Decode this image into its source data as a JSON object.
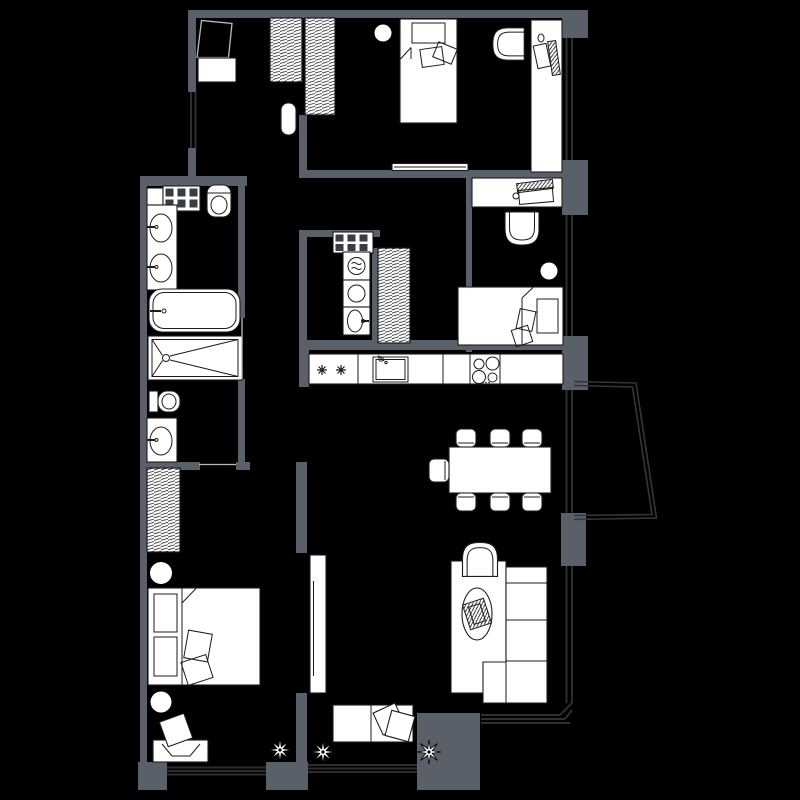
{
  "meta": {
    "kind": "apartment-floor-plan",
    "canvas": {
      "width": 800,
      "height": 800
    },
    "visible_text": "none"
  },
  "palette": {
    "background": "#000000",
    "wall": "#5a606a",
    "furniture_fill": "#ffffff",
    "furniture_stroke": "#1c1c1c",
    "window_line": "#2c2e33",
    "balcony_line": "#33363b",
    "door_line": "#b9bdc3",
    "grid_square": "#383d44"
  },
  "rooms": [
    {
      "name": "entry-hall",
      "furniture": [
        "entrance-door-swing",
        "cabinet",
        "wardrobe-hatched",
        "pouf"
      ]
    },
    {
      "name": "bedroom-top-right",
      "furniture": [
        "wardrobe-hatched",
        "single-bed",
        "pillows",
        "ceiling-lamp",
        "tub-armchair",
        "desk",
        "desk-chair",
        "laptop",
        "cup",
        "sliding-door"
      ]
    },
    {
      "name": "bathroom",
      "furniture": [
        "shelf",
        "vent-grid",
        "toilet",
        "double-washbasin-counter",
        "bathtub",
        "shower-tray"
      ]
    },
    {
      "name": "wc-ensuite",
      "furniture": [
        "toilet",
        "washbasin-counter",
        "sliding-door"
      ]
    },
    {
      "name": "laundry-room",
      "furniture": [
        "vent-grid",
        "washing-machine",
        "dryer",
        "laundry-sink",
        "closet-hatched"
      ]
    },
    {
      "name": "bedroom-middle-right",
      "furniture": [
        "desk",
        "laptop",
        "cup",
        "desk-chair",
        "tub-armchair",
        "ceiling-lamp",
        "single-bed",
        "pillows"
      ]
    },
    {
      "name": "kitchen",
      "furniture": [
        "counter",
        "hob-asterisks",
        "sink",
        "cooktop-4-burners"
      ]
    },
    {
      "name": "dining-area",
      "furniture": [
        "dining-table",
        "chairs-x7"
      ]
    },
    {
      "name": "living-room",
      "furniture": [
        "rug",
        "tub-armchair",
        "coffee-table-oval",
        "corner-sofa",
        "daybed-bench",
        "pillows",
        "plant",
        "plant",
        "sliding-door"
      ]
    },
    {
      "name": "bedroom-bottom-left",
      "furniture": [
        "wardrobe-hatched",
        "double-bed",
        "headboard-cushions",
        "pillows",
        "bedside-lamp",
        "bedside-lamp",
        "desk",
        "desk-chair",
        "plant"
      ]
    },
    {
      "name": "balcony",
      "furniture": []
    }
  ],
  "window_count": 8,
  "plant_count": 3,
  "dining_chair_count": 7
}
